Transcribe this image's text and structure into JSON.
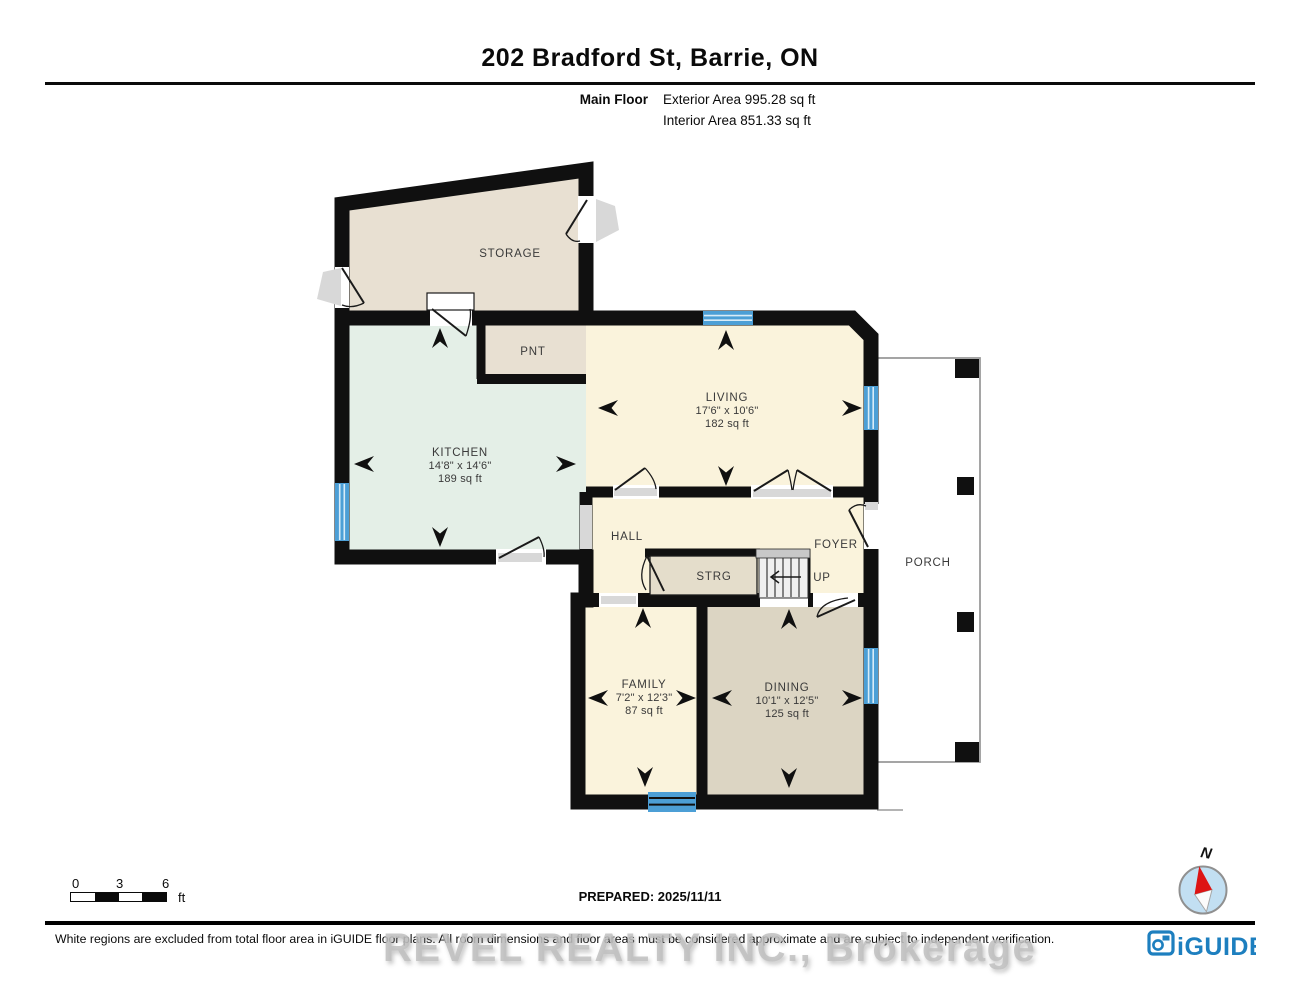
{
  "header": {
    "title": "202 Bradford St, Barrie, ON",
    "floor_label": "Main Floor",
    "exterior_area": "Exterior Area 995.28 sq ft",
    "interior_area": "Interior Area 851.33 sq ft"
  },
  "rooms": {
    "storage": {
      "name": "STORAGE"
    },
    "pnt": {
      "name": "PNT"
    },
    "kitchen": {
      "name": "KITCHEN",
      "dims": "14'8\" x 14'6\"",
      "area": "189 sq ft"
    },
    "living": {
      "name": "LIVING",
      "dims": "17'6\" x 10'6\"",
      "area": "182 sq ft"
    },
    "hall": {
      "name": "HALL"
    },
    "foyer": {
      "name": "FOYER"
    },
    "strg": {
      "name": "STRG"
    },
    "up": {
      "name": "UP"
    },
    "family": {
      "name": "FAMILY",
      "dims": "7'2\" x 12'3\"",
      "area": "87 sq ft"
    },
    "dining": {
      "name": "DINING",
      "dims": "10'1\" x 12'5\"",
      "area": "125 sq ft"
    },
    "porch": {
      "name": "PORCH"
    }
  },
  "scale_bar": {
    "tick0": "0",
    "tick3": "3",
    "tick6": "6",
    "unit": "ft"
  },
  "footer": {
    "prepared": "PREPARED: 2025/11/11",
    "disclaimer": "White regions are excluded from total floor area in iGUIDE floor plans. All room dimensions and floor areas must be considered approximate and are subject to independent verification.",
    "watermark": "REVEL REALTY INC., Brokerage",
    "logo": "iGUIDE",
    "compass_north": "N"
  },
  "colors": {
    "wall": "#101010",
    "cream_room": "#faf3dc",
    "mint_room": "#e4efe7",
    "beige_room": "#e8e0d2",
    "tan_room": "#dcd5c3",
    "window_blue": "#4c9fd6",
    "logo_blue": "#1d7fbf",
    "compass_fill": "#c2dff2",
    "needle_red": "#dd1414"
  }
}
